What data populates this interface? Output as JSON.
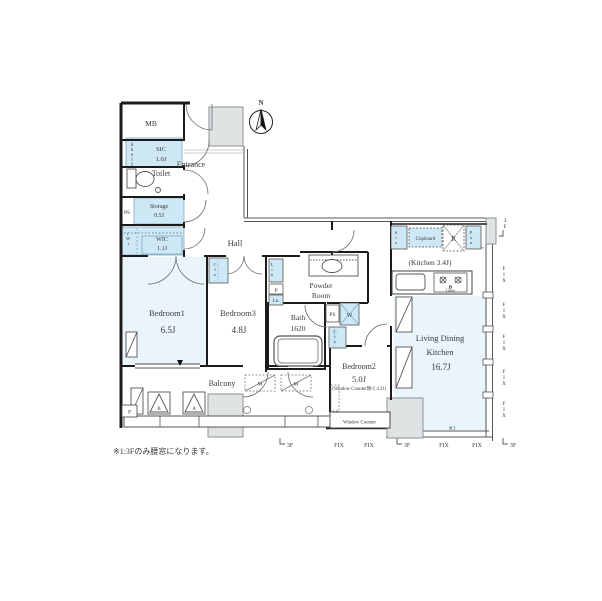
{
  "document_type": "apartment-floor-plan",
  "note": "※1:3Fのみ腰窓になります。",
  "compass": {
    "north": "N"
  },
  "rooms": {
    "mb": {
      "label": "MB"
    },
    "sic": {
      "label": "SIC",
      "size": "1.0J"
    },
    "shelf": {
      "label": "Shelf"
    },
    "entrance": {
      "label": "Entrance"
    },
    "toilet": {
      "label": "Toilet"
    },
    "storage": {
      "label": "Storage",
      "size": "0.5J"
    },
    "wic": {
      "label": "WIC",
      "size": "1.1J"
    },
    "hall": {
      "label": "Hall"
    },
    "bedroom1": {
      "label": "Bedroom1",
      "size": "6.5J"
    },
    "bedroom3": {
      "label": "Bedroom3",
      "size": "4.8J"
    },
    "bath": {
      "label": "Bath",
      "size": "1620"
    },
    "powder_room": {
      "label_line1": "Powder",
      "label_line2": "Room"
    },
    "bedroom2": {
      "label": "Bedroom2",
      "size": "5.0J",
      "note": "(Window Counter除く4.2J)"
    },
    "ldk": {
      "label_line1": "Living Dining",
      "label_line2": "Kitchen",
      "size": "16.7J"
    },
    "kitchen": {
      "label": "(Kitchen 3.4J)"
    },
    "balcony": {
      "label": "Balcony"
    }
  },
  "fixtures": {
    "ps": "PS",
    "w_vent": "(W)",
    "washer": "W",
    "closet": "Clo.",
    "linen": "Lin.",
    "p": "P",
    "ln": "Ln.",
    "sto": "Sto.",
    "cupboard": "Cupboard",
    "fridge": "R",
    "pantry": "Pan.",
    "stove_glass": "Glass",
    "window_counter": "Window Counter",
    "m": "M",
    "hatch_a": "A",
    "hatch_b": "B"
  },
  "annotations": {
    "fix": "FIX",
    "floor3": "3F",
    "ref1": "※1"
  },
  "colors": {
    "room_fill": "#eaf4fb",
    "closet_fill": "#cfe8f6",
    "gray_fill": "#e0e3e4",
    "wall": "#1b1b1b"
  }
}
